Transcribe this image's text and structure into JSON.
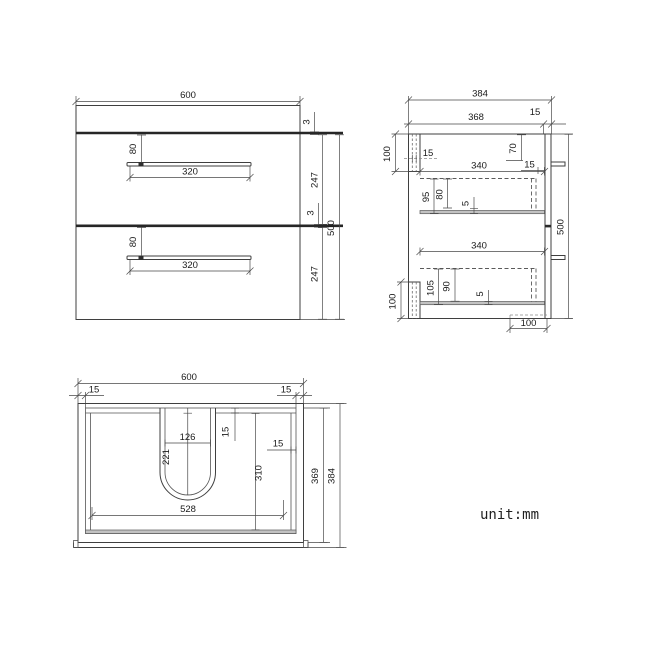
{
  "style": {
    "ink": "#3f3f3f",
    "thick_line": "#262626",
    "band_gray": "#c2c2c2"
  },
  "unit_label": "unit:mm",
  "front_view": {
    "width_label": "600",
    "height_label": "500",
    "right_dims": {
      "gap_top": "3",
      "drawer1_height": "247",
      "gap_middle": "3",
      "drawer2_height": "247"
    },
    "drawers": [
      {
        "handle_offset": "80",
        "handle_width": "320"
      },
      {
        "handle_offset": "80",
        "handle_width": "320"
      }
    ]
  },
  "side_view": {
    "depth_overall": "384",
    "depth_body": "368",
    "front_panel": "15",
    "top_rail_height": "100",
    "back_panel_thickness": "15",
    "top_clearance": "70",
    "front_gap": "15",
    "height_label": "500",
    "drawers": [
      {
        "depth": "340",
        "back_height": "95",
        "side_height": "80",
        "clearance": "5"
      },
      {
        "depth": "340",
        "back_height": "105",
        "side_height": "90",
        "clearance": "5"
      }
    ],
    "bottom_rail_height": "100",
    "bottom_recess_width": "100"
  },
  "plan_view": {
    "width_label": "600",
    "rim_left": "15",
    "rim_right": "15",
    "cutout_width": "126",
    "cutout_depth": "221",
    "rim_back": "15",
    "rim_side": "15",
    "bowl_depth": "310",
    "bowl_width": "528",
    "depth_inner": "369",
    "depth_overall": "384"
  }
}
